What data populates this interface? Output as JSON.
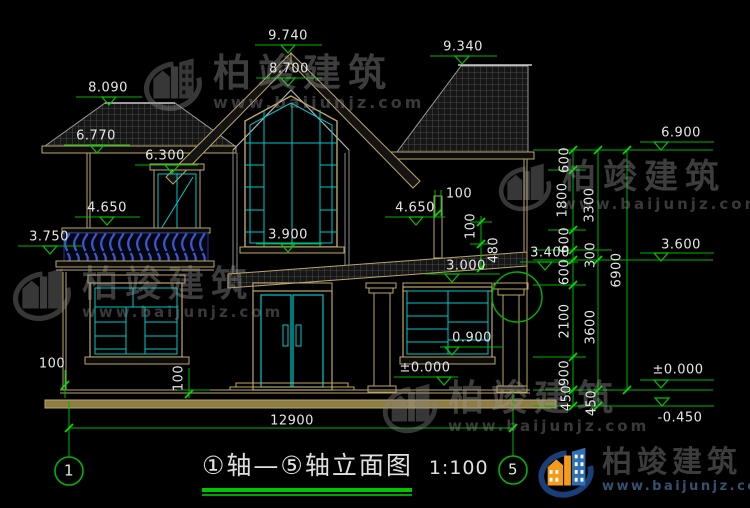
{
  "drawing_type": "house elevation CAD drawing",
  "levels": {
    "v9740": "9.740",
    "v9340": "9.340",
    "v8700": "8.700",
    "v8090": "8.090",
    "v6770": "6.770",
    "v6300": "6.300",
    "v4650L": "4.650",
    "v3750": "3.750",
    "v3900": "3.900",
    "v4650R": "4.650",
    "v3400": "3.400",
    "v3000": "3.000",
    "v6900": "6.900",
    "v3600": "3.600",
    "v0900": "0.900",
    "v0000a": "±0.000",
    "v0000b": "±0.000",
    "vm0450": "-0.450"
  },
  "dims": {
    "total": "12900",
    "d100a": "100",
    "d100b": "100",
    "d480": "480",
    "d100c": "100",
    "d100d": "100",
    "inner": [
      "600",
      "1800",
      "600",
      "300",
      "600",
      "2100",
      "900",
      "450"
    ],
    "mid": [
      "3300",
      "3600",
      "450"
    ],
    "outer": "6900"
  },
  "footer": {
    "axis_left": "1",
    "axis_right": "5",
    "title": "①轴—⑤轴立面图",
    "scale": "1:100"
  },
  "watermark": {
    "brand": "柏竣建筑",
    "url": "www.baijunjz.com"
  },
  "logo": {
    "brand": "柏竣建筑",
    "url": "www.baijunjz.com"
  },
  "colors": {
    "dim_green": "#00b400",
    "cad_tan": "#bda768",
    "window_cyan": "#00c8c8",
    "railing_blue": "#3a57d6",
    "logo_blue": "#2f6fb4",
    "logo_orange": "#f49c1a"
  }
}
